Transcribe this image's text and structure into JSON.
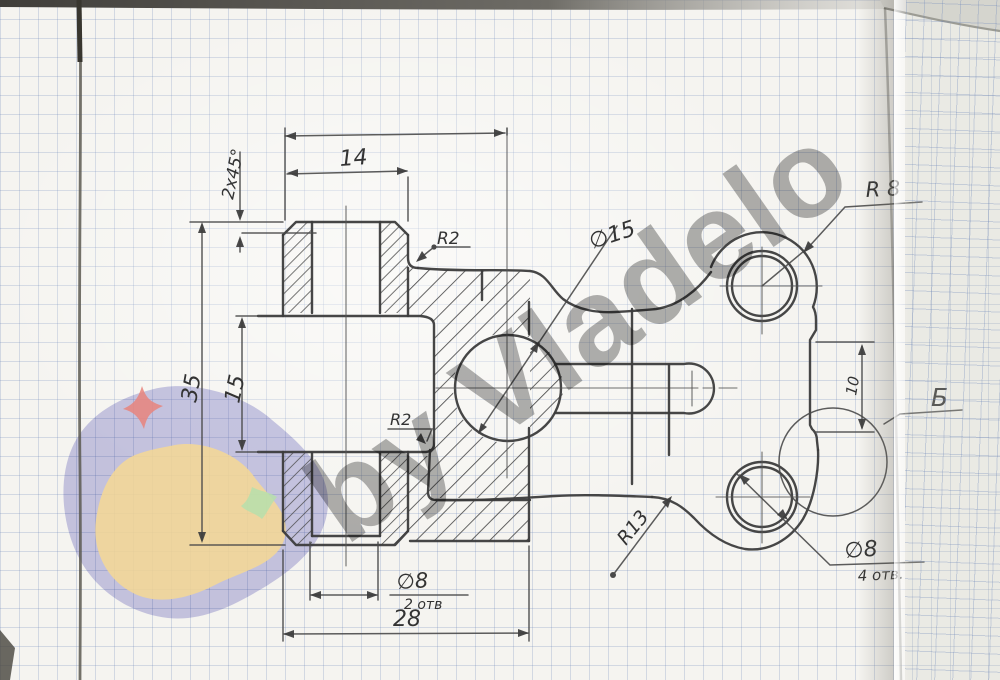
{
  "watermark": {
    "brand": "by Vladelo"
  },
  "labels": {
    "top_width": "14",
    "overall_height": "35",
    "groove_height": "15",
    "overall_width": "28",
    "chamfer": "2x45°",
    "fillet_top": "R2",
    "fillet_groove": "R2",
    "center_hole": "∅15",
    "lobe_radius": "R 8",
    "plate_fillet": "R13",
    "step_offset": "10",
    "detail_view": "Б",
    "hub_hole": "∅8",
    "hub_hole_qty": "2 отв",
    "lobe_hole": "∅8",
    "lobe_hole_qty": "4 отв."
  }
}
